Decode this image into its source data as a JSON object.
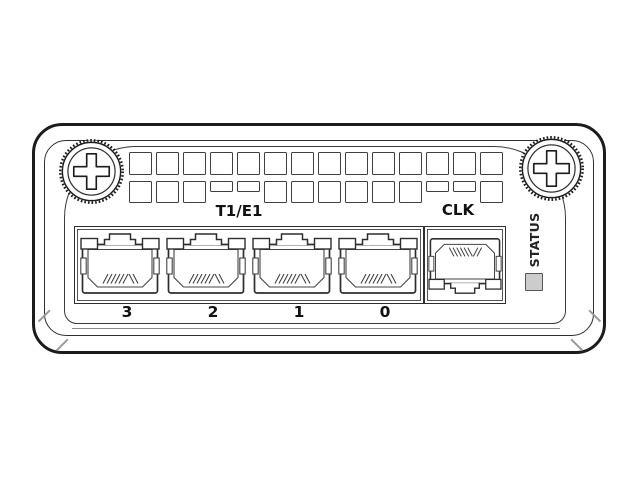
{
  "device": {
    "labels": {
      "group": "T1/E1",
      "clock": "CLK",
      "status": "STATUS"
    },
    "ports": [
      {
        "label": "3"
      },
      {
        "label": "2"
      },
      {
        "label": "1"
      },
      {
        "label": "0"
      }
    ],
    "vents": {
      "columns": 14,
      "rows": 2,
      "half_cells_bottom_row": [
        3,
        4,
        11,
        12
      ]
    },
    "icons": {
      "screws": "phillips-thumbscrew-icon",
      "ports": "rj45-jack-icon",
      "clock_port": "rj45-jack-flipped-icon",
      "led": "status-led-square"
    },
    "colors": {
      "line": "#1c1c1c",
      "line_mid": "#3a3a3a",
      "line_soft": "#8a8a8a",
      "led_fill": "#cccccc",
      "background": "#ffffff"
    }
  }
}
